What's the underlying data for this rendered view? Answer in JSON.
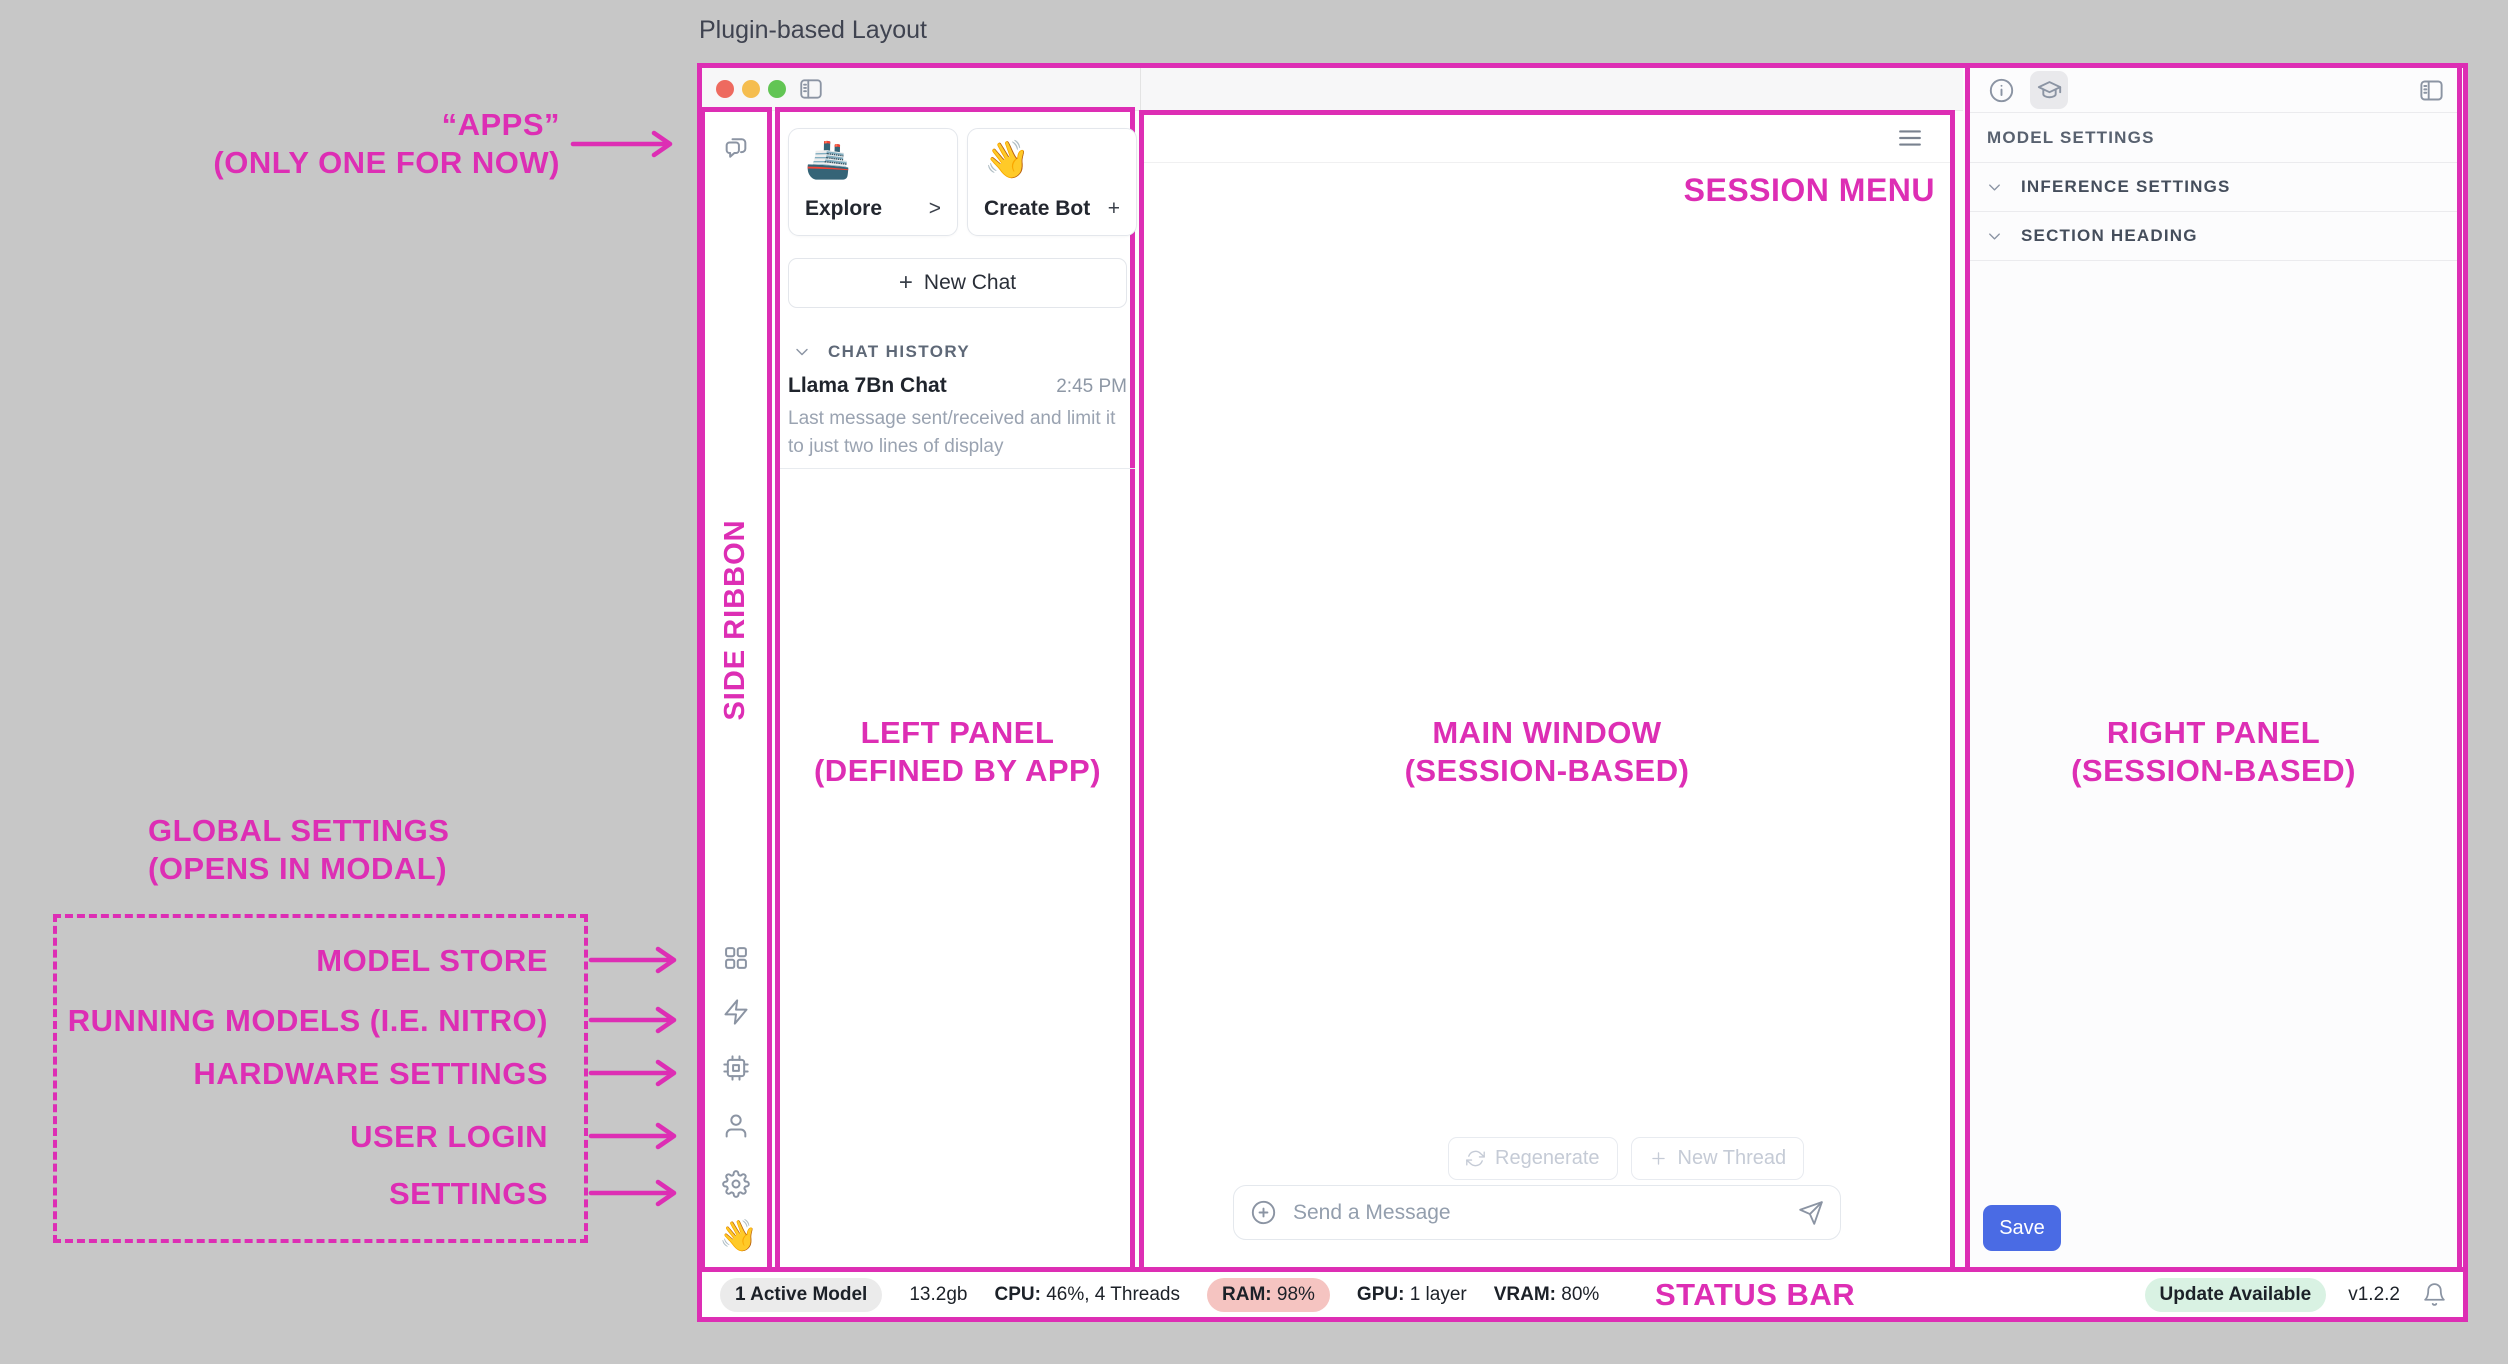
{
  "frame": {
    "title": "Plugin-based Layout"
  },
  "annotations": {
    "apps": {
      "line1": "“APPS”",
      "line2": "(ONLY ONE FOR NOW)"
    },
    "global_settings": {
      "line1": "GLOBAL SETTINGS",
      "line2": "(OPENS IN MODAL)"
    },
    "modal_items": [
      "MODEL STORE",
      "RUNNING MODELS (I.E. NITRO)",
      "HARDWARE SETTINGS",
      "USER LOGIN",
      "SETTINGS"
    ],
    "side_ribbon": "SIDE RIBBON",
    "left_panel": {
      "line1": "LEFT PANEL",
      "line2": "(DEFINED BY APP)"
    },
    "main_window": {
      "line1": "MAIN WINDOW",
      "line2": "(SESSION-BASED)"
    },
    "right_panel": {
      "line1": "RIGHT PANEL",
      "line2": "(SESSION-BASED)"
    },
    "session_menu": "SESSION MENU",
    "status_bar_label": "STATUS BAR"
  },
  "left_panel": {
    "cards": [
      {
        "emoji": "🚢",
        "label": "Explore",
        "action": ">"
      },
      {
        "emoji": "👋",
        "label": "Create Bot",
        "action": "+"
      }
    ],
    "new_chat": {
      "plus": "+",
      "label": "New Chat"
    },
    "chat_history_label": "CHAT HISTORY",
    "chat_items": [
      {
        "title": "Llama 7Bn Chat",
        "time": "2:45 PM",
        "preview": "Last message sent/received and limit it to just two lines of display"
      }
    ]
  },
  "main_window": {
    "regenerate_label": "Regenerate",
    "new_thread_label": "New Thread",
    "message_placeholder": "Send a Message"
  },
  "right_panel": {
    "model_settings_label": "MODEL SETTINGS",
    "sections": [
      {
        "label": "INFERENCE SETTINGS"
      },
      {
        "label": "SECTION HEADING"
      }
    ],
    "save_label": "Save"
  },
  "status_bar": {
    "active_model": "1 Active Model",
    "memory": "13.2gb",
    "cpu": {
      "label": "CPU:",
      "value": "46%, 4 Threads"
    },
    "ram": {
      "label": "RAM:",
      "value": "98%"
    },
    "gpu": {
      "label": "GPU:",
      "value": "1 layer"
    },
    "vram": {
      "label": "VRAM:",
      "value": "80%"
    },
    "update_badge": "Update Available",
    "version": "v1.2.2"
  },
  "icons": {
    "ribbon_wave": "👋"
  },
  "colors": {
    "accent": "#DD2EB4",
    "save_button": "#4A6BE4",
    "ram_badge_bg": "#F5C4C1",
    "update_badge_bg": "#D9F2E3",
    "traffic_red": "#EE6A5F",
    "traffic_yellow": "#F5BD4F",
    "traffic_green": "#62C554"
  }
}
